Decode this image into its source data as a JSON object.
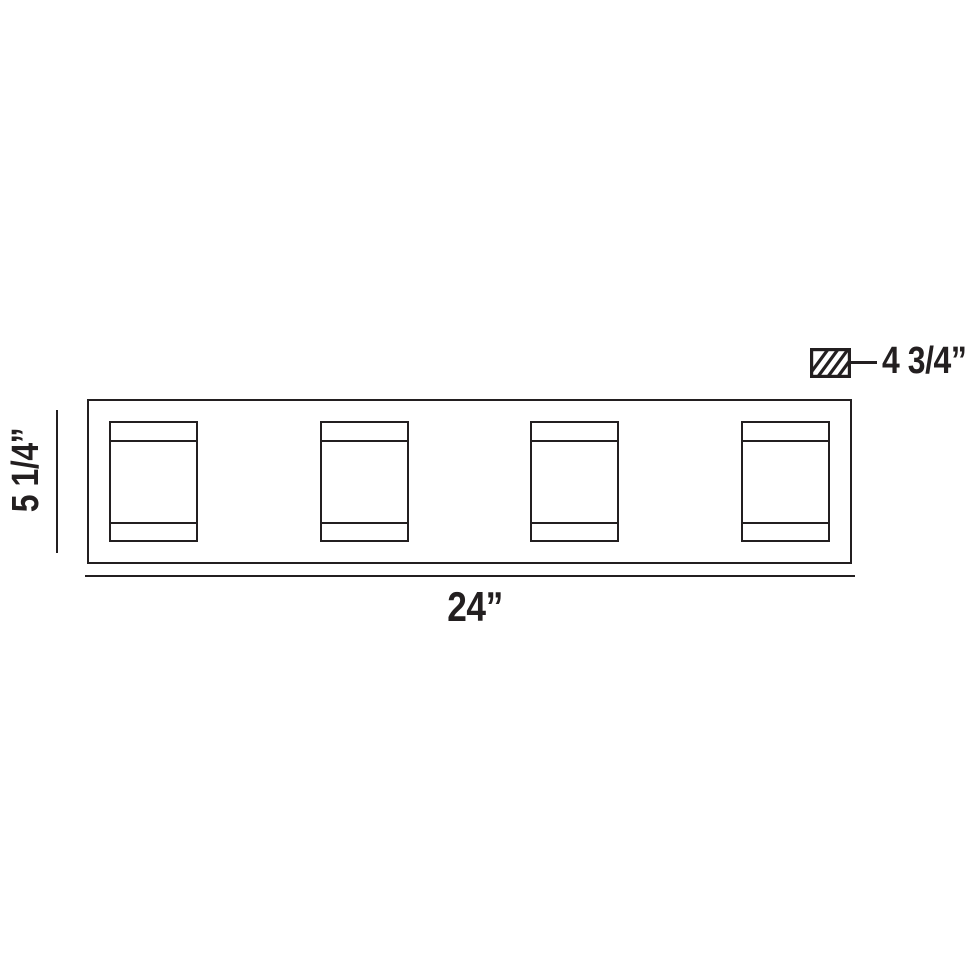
{
  "page": {
    "background_color": "#ffffff",
    "line_color": "#231f20"
  },
  "diagram": {
    "kind": "light-fixture-dimension-drawing",
    "dimensions": {
      "width_label": "24”",
      "height_label": "5 1/4”",
      "depth_label": "4 3/4”"
    },
    "fixture": {
      "shade_count": 4
    },
    "icons": {
      "depth_swatch": "diagonal-hatch-swatch-icon"
    }
  }
}
